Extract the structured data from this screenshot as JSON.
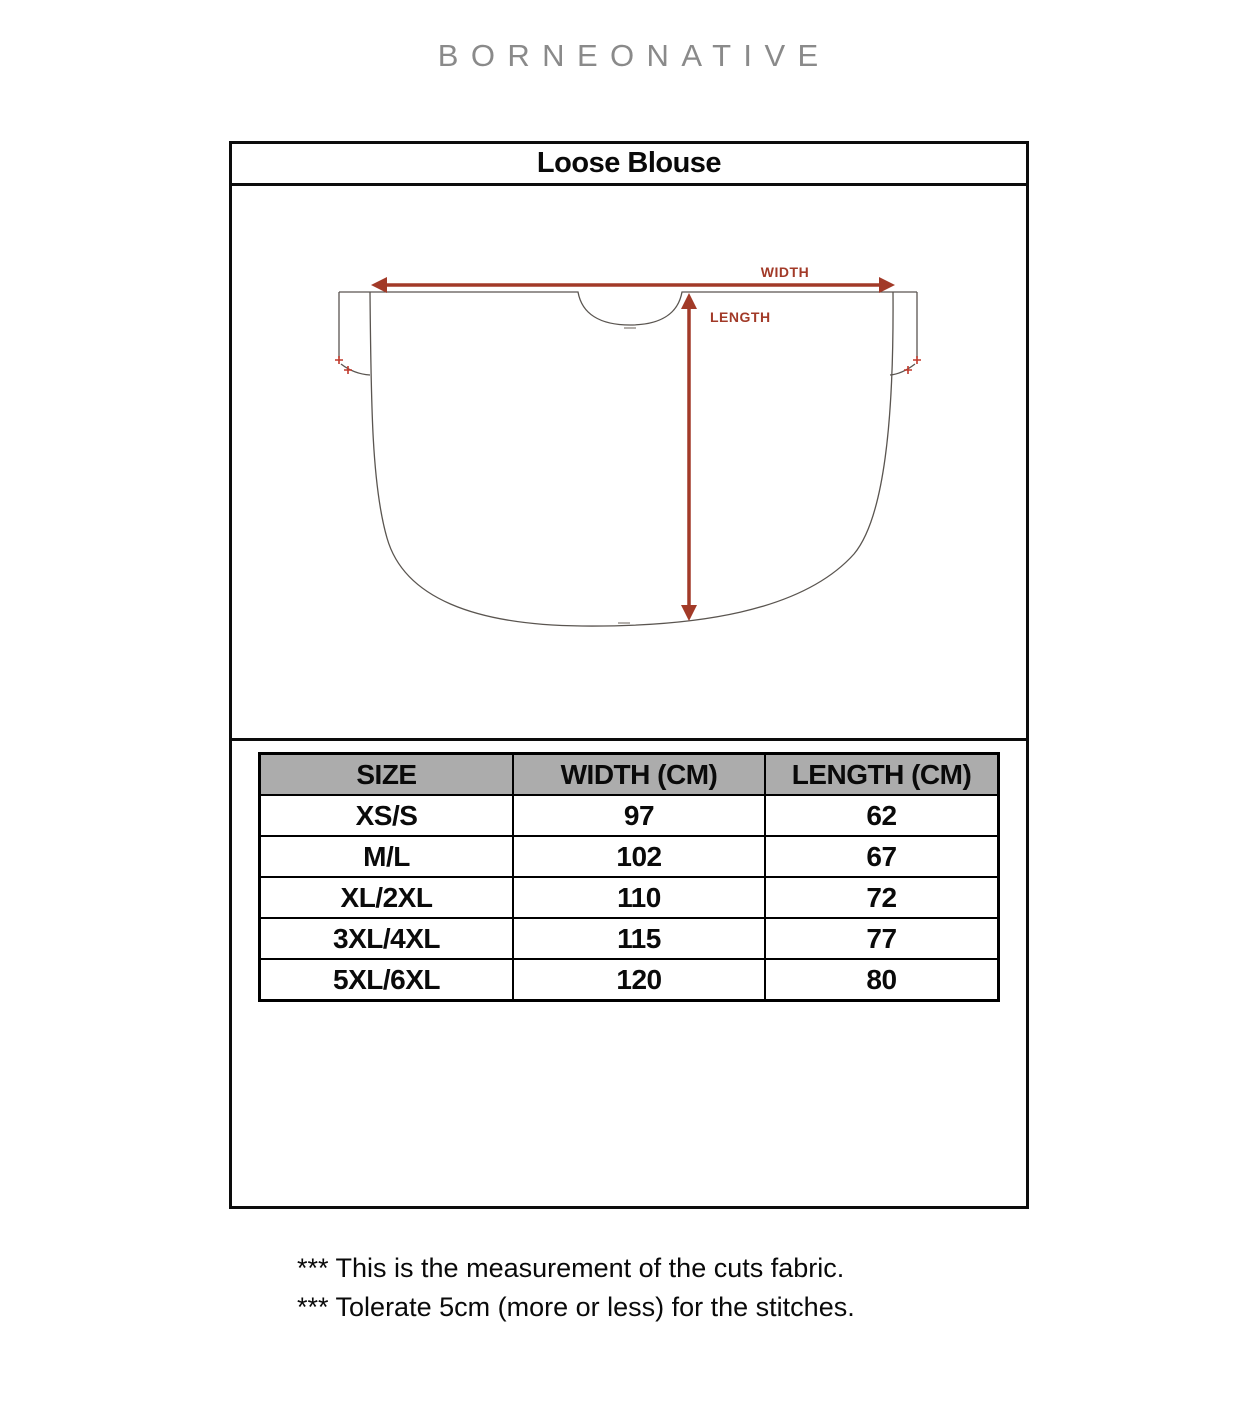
{
  "brand": "BORNEONATIVE",
  "sheet": {
    "title": "Loose Blouse"
  },
  "diagram": {
    "width_label": "WIDTH",
    "length_label": "LENGTH",
    "arrow_color": "#A23A28",
    "outline_color": "#5a5550"
  },
  "size_table": {
    "header_bg": "#ACACAC",
    "headers": [
      "SIZE",
      "WIDTH (CM)",
      "LENGTH (CM)"
    ],
    "rows": [
      {
        "size": "XS/S",
        "width_cm": "97",
        "length_cm": "62"
      },
      {
        "size": "M/L",
        "width_cm": "102",
        "length_cm": "67"
      },
      {
        "size": "XL/2XL",
        "width_cm": "110",
        "length_cm": "72"
      },
      {
        "size": "3XL/4XL",
        "width_cm": "115",
        "length_cm": "77"
      },
      {
        "size": "5XL/6XL",
        "width_cm": "120",
        "length_cm": "80"
      }
    ]
  },
  "notes": [
    "*** This is the measurement of the cuts fabric.",
    "*** Tolerate 5cm (more or less) for the stitches."
  ]
}
